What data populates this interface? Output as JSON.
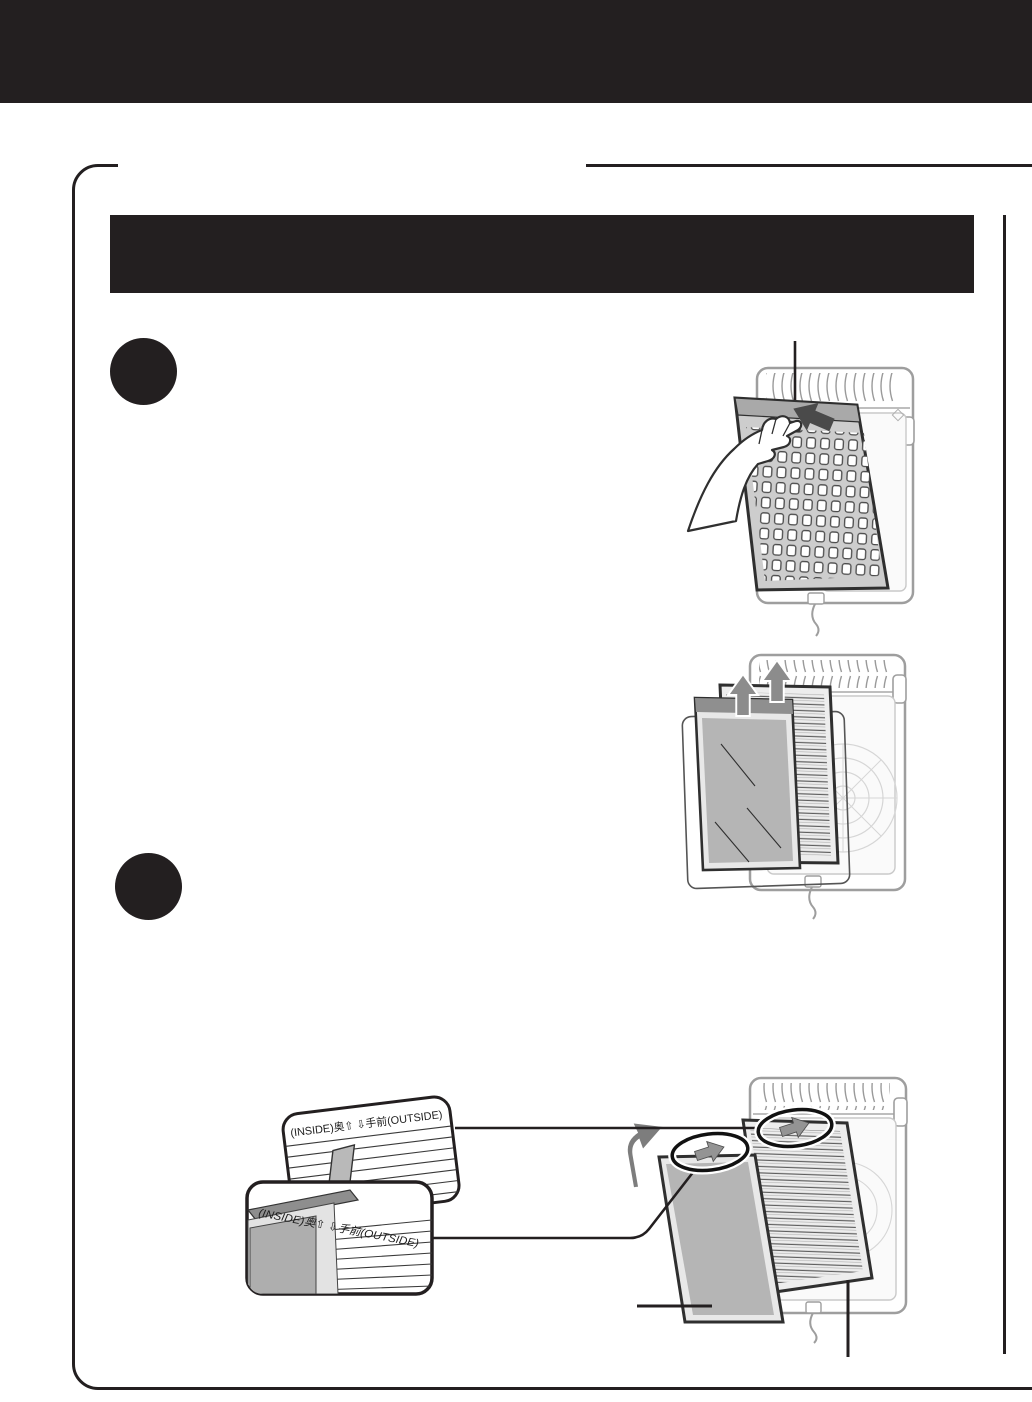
{
  "colors": {
    "ink": "#231f20",
    "paper": "#ffffff",
    "panel-gray": "#b5b5b5",
    "panel-dark": "#8f8f8f",
    "panel-light": "#e6e6e6",
    "outline-gray": "#9e9e9e",
    "arrow-gray": "#7d7d7d",
    "arrow-dark": "#4a4a4a"
  },
  "callouts": {
    "top": {
      "label": "(INSIDE)奥⇧ ⇩手前(OUTSIDE)"
    },
    "bottom": {
      "label": "(INSIDE)奥⇧ ⇩手前(OUTSIDE)"
    }
  }
}
